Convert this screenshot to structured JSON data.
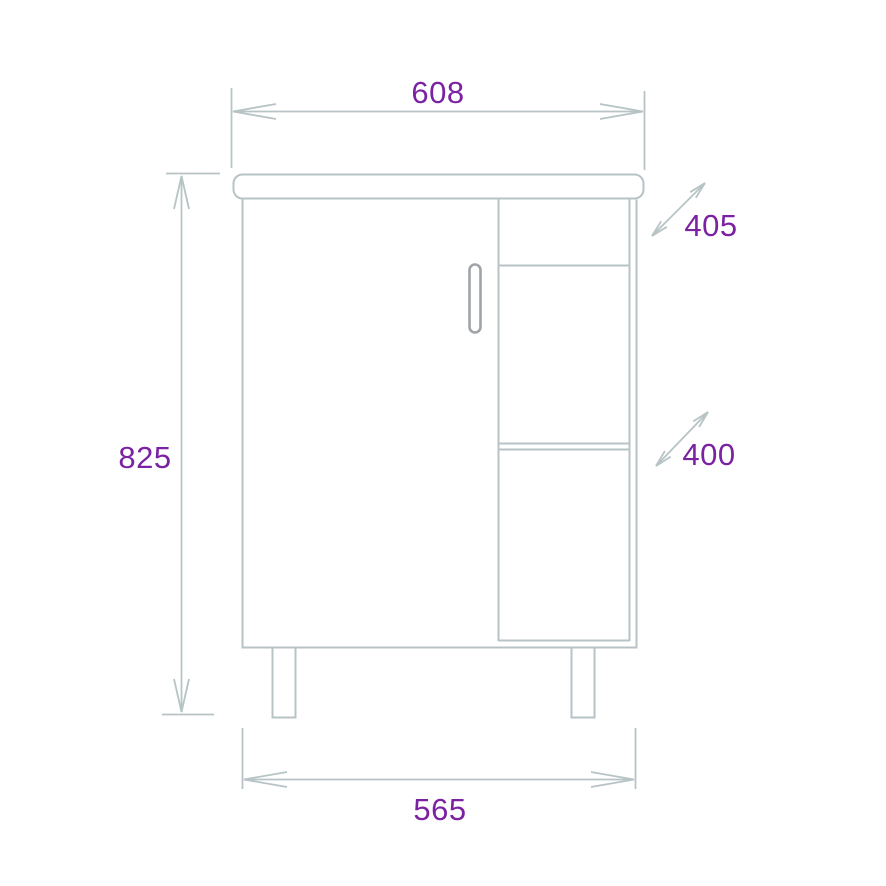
{
  "drawing": {
    "subject": "vanity-cabinet-front-elevation",
    "dimension_labels": {
      "top_width": "608",
      "overall_height": "825",
      "bottom_width": "565",
      "upper_depth": "405",
      "lower_depth": "400"
    },
    "colors": {
      "line": "#b7c3c5",
      "handle_stroke": "#9fa4a8",
      "dimension_text": "#7b22a3",
      "background": "#ffffff"
    }
  }
}
